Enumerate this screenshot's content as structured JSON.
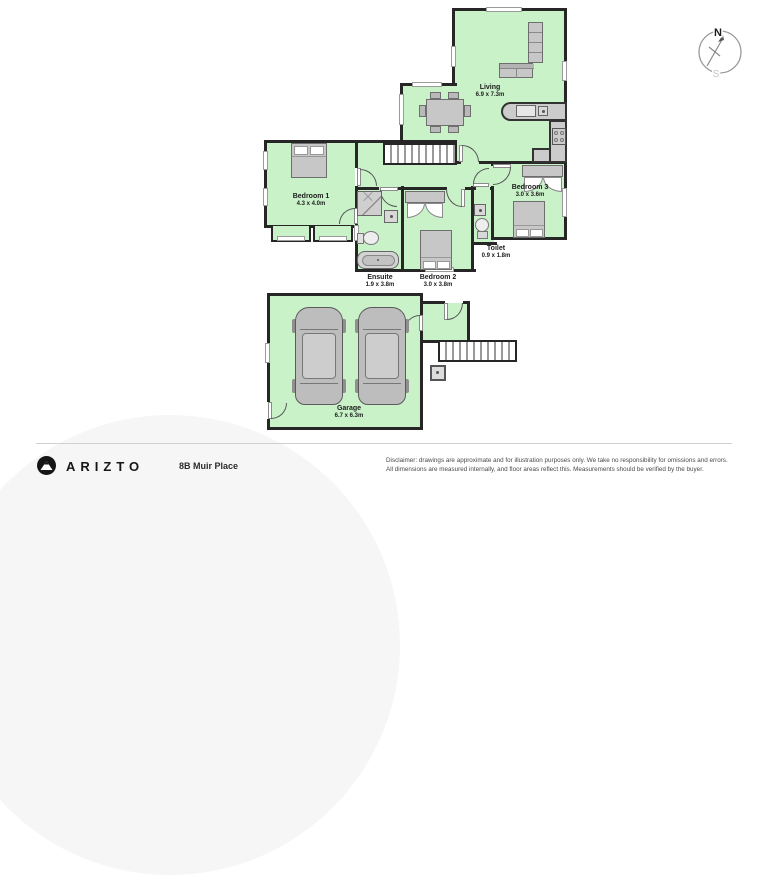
{
  "compass": {
    "north": "N",
    "south": "S"
  },
  "rooms": {
    "living": {
      "name": "Living",
      "dims": "6.9 x 7.3m"
    },
    "bedroom1": {
      "name": "Bedroom 1",
      "dims": "4.3 x 4.0m"
    },
    "bedroom2": {
      "name": "Bedroom 2",
      "dims": "3.0 x 3.8m"
    },
    "bedroom3": {
      "name": "Bedroom 3",
      "dims": "3.0 x 3.6m"
    },
    "ensuite": {
      "name": "Ensuite",
      "dims": "1.9 x 3.8m"
    },
    "toilet": {
      "name": "Toilet",
      "dims": "0.9 x 1.8m"
    },
    "garage": {
      "name": "Garage",
      "dims": "6.7 x 6.3m"
    }
  },
  "footer": {
    "brand": "ARIZTO",
    "address": "8B Muir Place",
    "disclaimer_line1": "Disclaimer: drawings are approximate and for illustration purposes only. We take no responsibility for omissions and errors.",
    "disclaimer_line2": "All dimensions are measured internally, and floor areas reflect this. Measurements should be verified by the buyer."
  },
  "colors": {
    "floor": "#c9f2c9",
    "wall": "#262626",
    "furniture": "#c7c7c7"
  }
}
